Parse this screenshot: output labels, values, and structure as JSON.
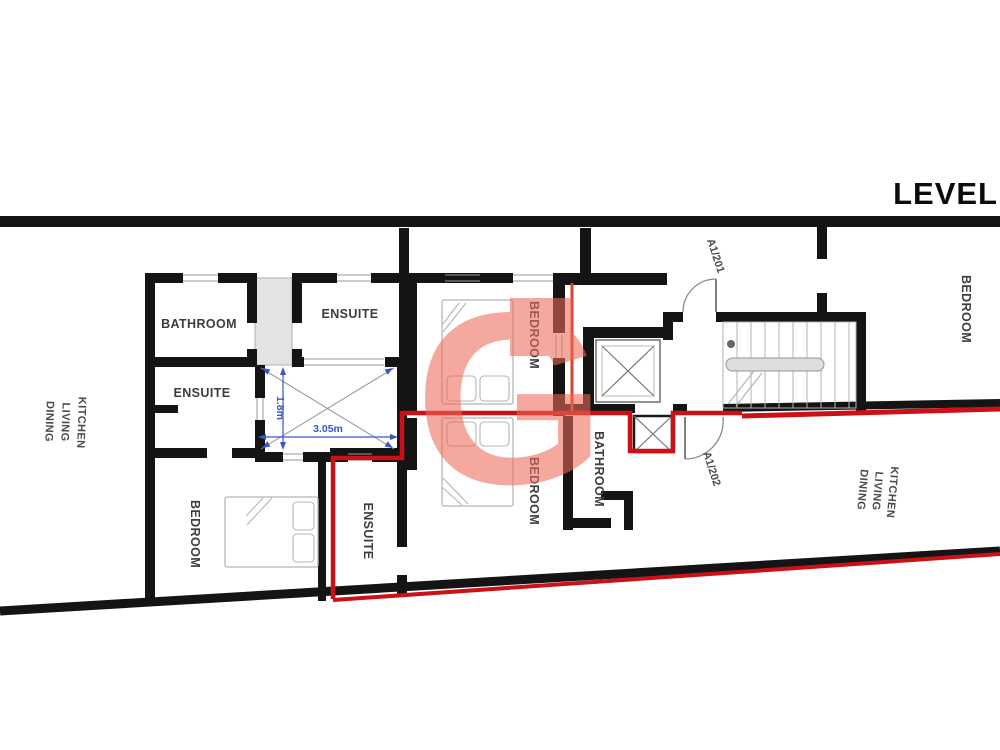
{
  "page": {
    "title": "LEVEL"
  },
  "watermark": {
    "letter": "G"
  },
  "labels": {
    "bathroom_top_left": "BATHROOM",
    "ensuite_top_center": "ENSUITE",
    "ensuite_mid_left": "ENSUITE",
    "ensuite_bottom_center": "ENSUITE",
    "bedroom_top_center": "BEDROOM",
    "bedroom_bottom_center": "BEDROOM",
    "bedroom_bottom_left": "BEDROOM",
    "bedroom_top_right": "BEDROOM",
    "bathroom_mid_right": "BATHROOM",
    "kitchen_living_dining": [
      "KITCHEN",
      "LIVING",
      "DINING"
    ],
    "unit_doors": {
      "a1_201": "A1/201",
      "a1_202": "A1/202"
    }
  },
  "dimensions": {
    "room_width": "3.05m",
    "room_depth": "1.8m"
  },
  "colors": {
    "wall": "#141414",
    "demise": "#cc1016",
    "dimension": "#3c55c5",
    "watermark": "#ee6a59",
    "fixture": "#b5b5b5",
    "shade": "#e3e3e3",
    "label": "#3d3d3d"
  }
}
